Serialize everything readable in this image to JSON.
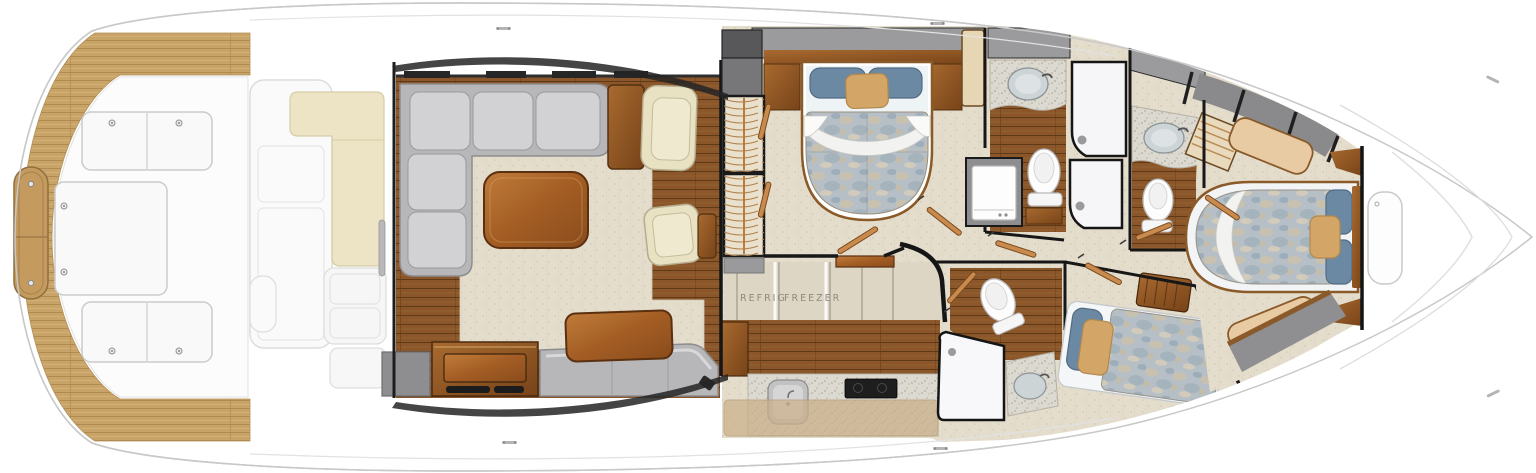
{
  "diagram": {
    "kind": "yacht-interior-floorplan",
    "labels": {
      "refrig": "REFRIG",
      "freezer": "FREEZER"
    },
    "colors": {
      "hull_white": "#ffffff",
      "hull_outline": "#c8c8c8",
      "teak_light": "#c9a469",
      "wood_floor": "#8a562a",
      "wood_furniture": "#b06a30",
      "carpet_beige": "#e3dccb",
      "sofa_gray": "#b7b7b9",
      "cushion_cream": "#ece4c4",
      "pillow_blue": "#6c89a3",
      "pillow_tan": "#d3a668",
      "duvet_mottle": "#b6bfc5",
      "deck_gray": "#9b9b9d",
      "counter_speckle": "#dcd9d1",
      "wall_dark": "#1a1a1a",
      "bar_tan": "#cbb089"
    }
  }
}
